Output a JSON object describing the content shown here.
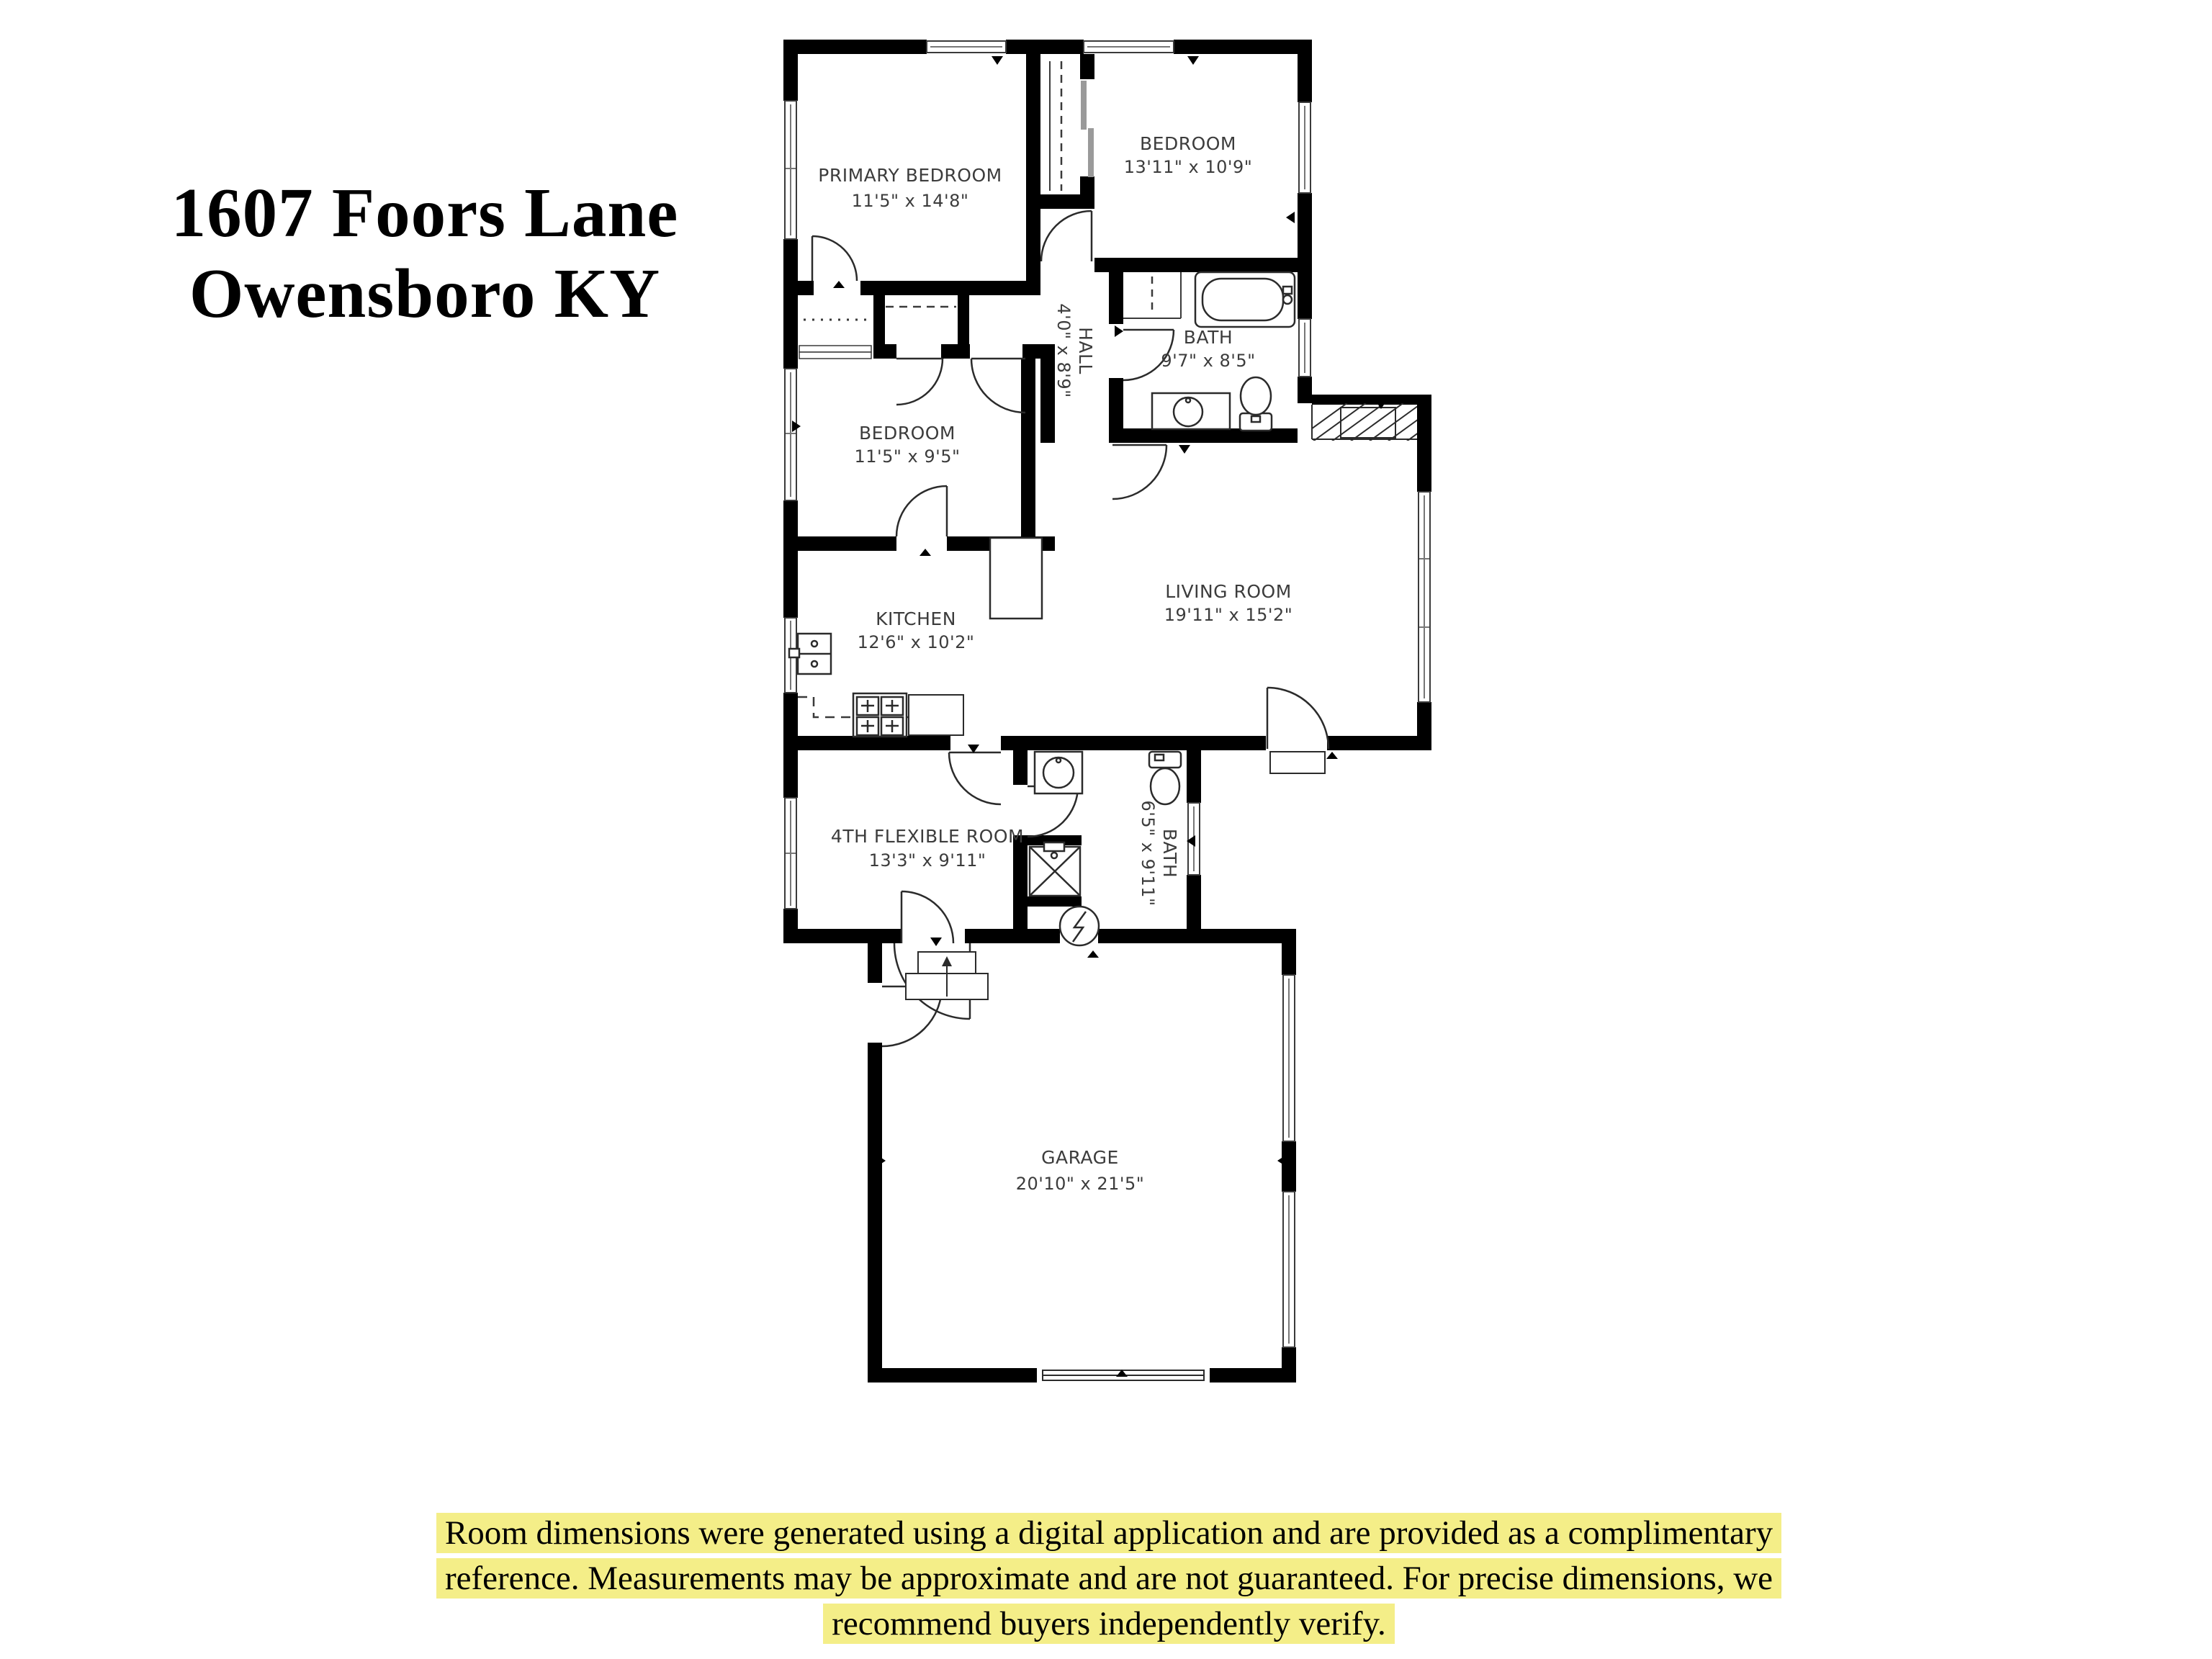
{
  "title": {
    "line1": "1607 Foors Lane",
    "line2": "Owensboro KY"
  },
  "plan": {
    "rooms": [
      {
        "id": "primary-bedroom",
        "name": "PRIMARY BEDROOM",
        "dims": "11'5\" x 14'8\""
      },
      {
        "id": "bedroom-top-right",
        "name": "BEDROOM",
        "dims": "13'11\" x 10'9\""
      },
      {
        "id": "bath-main",
        "name": "BATH",
        "dims": "9'7\" x 8'5\""
      },
      {
        "id": "hall",
        "name": "HALL",
        "dims": "4'0\" x 8'9\""
      },
      {
        "id": "bedroom-middle",
        "name": "BEDROOM",
        "dims": "11'5\" x 9'5\""
      },
      {
        "id": "kitchen",
        "name": "KITCHEN",
        "dims": "12'6\" x 10'2\""
      },
      {
        "id": "living-room",
        "name": "LIVING ROOM",
        "dims": "19'11\" x 15'2\""
      },
      {
        "id": "flex-room",
        "name": "4TH FLEXIBLE ROOM",
        "dims": "13'3\" x 9'11\""
      },
      {
        "id": "bath-second",
        "name": "BATH",
        "dims": "6'5\" x 9'11\""
      },
      {
        "id": "garage",
        "name": "GARAGE",
        "dims": "20'10\" x 21'5\""
      }
    ]
  },
  "disclaimer": {
    "line1": "Room dimensions were generated using a digital application and are provided as a complimentary",
    "line2": "reference. Measurements may be  approximate and are not guaranteed. For precise dimensions, we",
    "line3": "recommend buyers independently verify."
  },
  "colors": {
    "wall": "#000000",
    "highlight": "#f4ee88",
    "label": "#3c3c3c",
    "window_line": "#777777"
  }
}
